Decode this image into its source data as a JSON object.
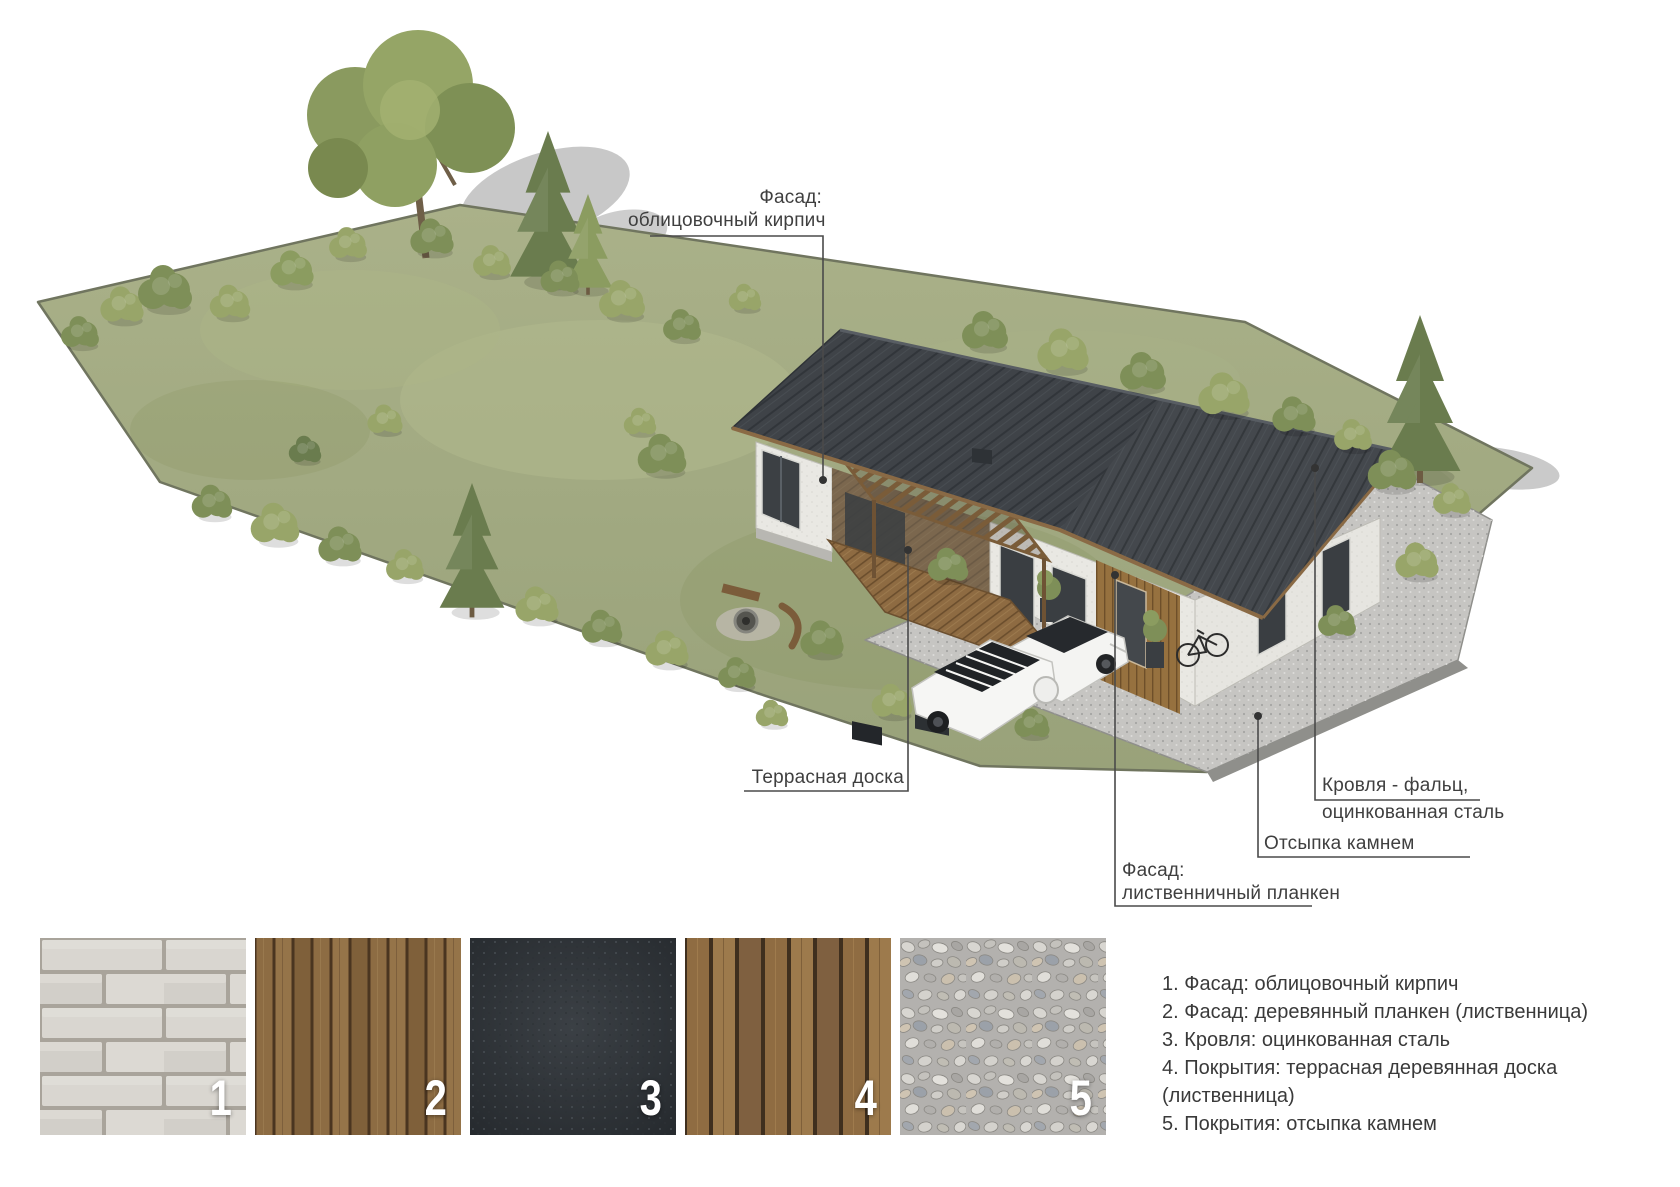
{
  "callouts": {
    "facade_brick": {
      "line1": "Фасад:",
      "line2": "облицовочный кирпич"
    },
    "terrace_deck": {
      "label": "Террасная доска"
    },
    "roof": {
      "line1": "Кровля  - фальц,",
      "line2": "оцинкованная сталь"
    },
    "stone_fill": {
      "label": "Отсыпка камнем"
    },
    "facade_plank": {
      "line1": "Фасад:",
      "line2": "лиственничный планкен"
    }
  },
  "swatches": [
    {
      "number": "1",
      "material": "facing-brick"
    },
    {
      "number": "2",
      "material": "wood-plank-larch"
    },
    {
      "number": "3",
      "material": "galvanized-steel"
    },
    {
      "number": "4",
      "material": "terrace-board"
    },
    {
      "number": "5",
      "material": "stone-gravel"
    }
  ],
  "legend": {
    "items": [
      "1. Фасад: облицовочный кирпич",
      "2. Фасад: деревянный планкен (лиственница)",
      "3. Кровля: оцинкованная сталь",
      "4. Покрытия: террасная деревянная доска (лиственница)",
      "5. Покрытия: отсыпка камнем"
    ]
  },
  "colors": {
    "roof": "#3e4247",
    "grass": "#a3ab83",
    "gravel": "#c6c5c2",
    "wood": "#8a6a42",
    "brick": "#d9d6d0",
    "text": "#3a3a3a",
    "leader_line": "#4a4a4a"
  }
}
